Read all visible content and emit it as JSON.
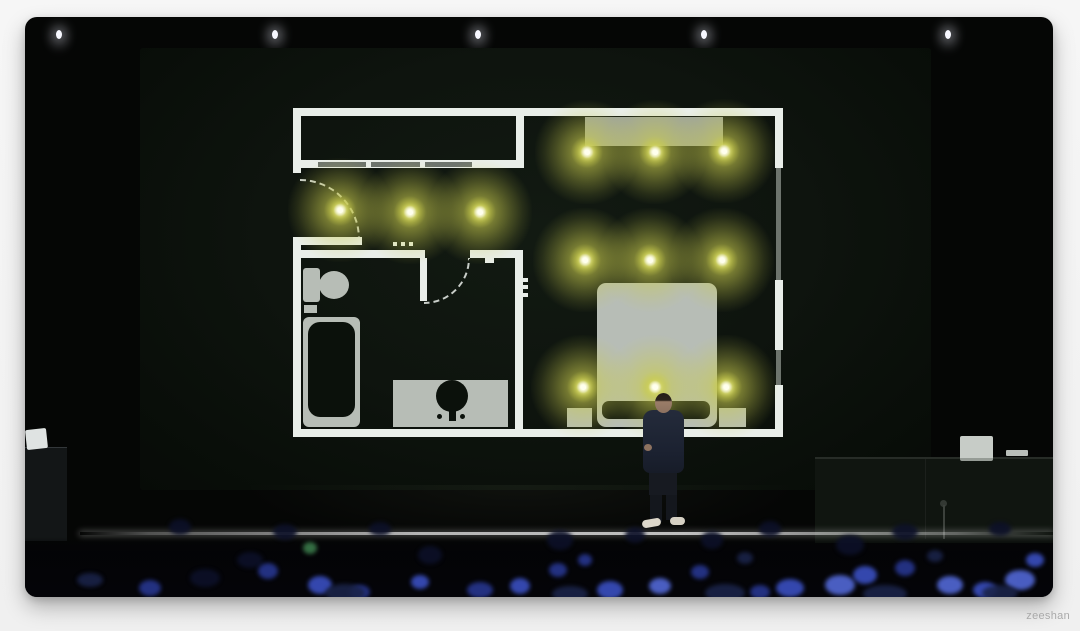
{
  "watermark": {
    "text": "zeeshan"
  },
  "scene": {
    "type": "keynote-stage-photo",
    "ceiling_lights": {
      "count": 5,
      "x_positions": [
        34,
        250,
        453,
        679,
        923
      ],
      "y": 13,
      "color": "#f7f8ff"
    }
  },
  "floor_plan": {
    "background": "#0b110b",
    "wall_color": "#e9eee9",
    "window_color": "#6d746d",
    "furniture_color": "#b7bdb6",
    "light_color": "#c9cc4e",
    "light_core_color": "#fffef2",
    "lights_on_count": 12,
    "rooms": [
      "closet",
      "hallway",
      "bathroom",
      "bedroom"
    ],
    "fixtures": [
      "closet-doors",
      "entry-door",
      "bathroom-door",
      "toilet",
      "bathtub",
      "vanity-sink",
      "console",
      "bed",
      "nightstand-left",
      "nightstand-right"
    ],
    "lights": [
      {
        "room": "hallway",
        "x": 47,
        "y": 102
      },
      {
        "room": "hallway",
        "x": 117,
        "y": 104
      },
      {
        "room": "hallway",
        "x": 187,
        "y": 104
      },
      {
        "room": "bedroom",
        "x": 294,
        "y": 44
      },
      {
        "room": "bedroom",
        "x": 362,
        "y": 44
      },
      {
        "room": "bedroom",
        "x": 431,
        "y": 43
      },
      {
        "room": "bedroom",
        "x": 292,
        "y": 152
      },
      {
        "room": "bedroom",
        "x": 357,
        "y": 152
      },
      {
        "room": "bedroom",
        "x": 429,
        "y": 152
      },
      {
        "room": "bedroom",
        "x": 290,
        "y": 279
      },
      {
        "room": "bedroom",
        "x": 362,
        "y": 279
      },
      {
        "room": "bedroom",
        "x": 433,
        "y": 279
      }
    ]
  },
  "presenter": {
    "shirt_color": "#1d2330",
    "pants_color": "#14171d",
    "shoe_color": "#ddd8cb",
    "skin_color": "#9a7d68"
  },
  "audience": {
    "palette": [
      "#14205c",
      "#27368f",
      "#3a4fc0",
      "#5268d6",
      "#1a2348",
      "#3a7a4a",
      "#0c1028"
    ],
    "blobs": [
      [
        65,
        563,
        26,
        14,
        4
      ],
      [
        125,
        571,
        22,
        16,
        1
      ],
      [
        180,
        561,
        30,
        18,
        6
      ],
      [
        225,
        543,
        26,
        16,
        6
      ],
      [
        243,
        554,
        20,
        16,
        1
      ],
      [
        285,
        531,
        14,
        12,
        5
      ],
      [
        295,
        568,
        24,
        18,
        2
      ],
      [
        335,
        575,
        20,
        14,
        1
      ],
      [
        395,
        565,
        18,
        14,
        2
      ],
      [
        405,
        538,
        24,
        18,
        6
      ],
      [
        455,
        573,
        26,
        16,
        1
      ],
      [
        495,
        569,
        20,
        16,
        2
      ],
      [
        533,
        553,
        18,
        14,
        1
      ],
      [
        535,
        523,
        26,
        20,
        6
      ],
      [
        560,
        543,
        14,
        12,
        1
      ],
      [
        585,
        573,
        26,
        18,
        2
      ],
      [
        635,
        569,
        22,
        16,
        3
      ],
      [
        675,
        555,
        18,
        14,
        1
      ],
      [
        687,
        523,
        22,
        18,
        6
      ],
      [
        720,
        541,
        16,
        12,
        4
      ],
      [
        735,
        575,
        20,
        14,
        1
      ],
      [
        765,
        571,
        28,
        18,
        2
      ],
      [
        815,
        568,
        30,
        20,
        3
      ],
      [
        825,
        528,
        28,
        20,
        6
      ],
      [
        840,
        558,
        24,
        18,
        2
      ],
      [
        880,
        551,
        20,
        16,
        1
      ],
      [
        910,
        539,
        16,
        12,
        4
      ],
      [
        925,
        568,
        26,
        18,
        3
      ],
      [
        960,
        573,
        24,
        16,
        2
      ],
      [
        995,
        563,
        30,
        20,
        3
      ],
      [
        1010,
        543,
        18,
        14,
        2
      ],
      [
        155,
        510,
        22,
        16,
        6
      ],
      [
        260,
        515,
        24,
        16,
        6
      ],
      [
        355,
        512,
        22,
        14,
        6
      ],
      [
        610,
        518,
        20,
        16,
        6
      ],
      [
        745,
        512,
        22,
        16,
        6
      ],
      [
        880,
        515,
        26,
        16,
        6
      ],
      [
        975,
        512,
        22,
        14,
        6
      ],
      [
        320,
        576,
        40,
        18,
        4
      ],
      [
        545,
        577,
        36,
        16,
        4
      ],
      [
        700,
        576,
        40,
        18,
        4
      ],
      [
        860,
        577,
        44,
        18,
        4
      ],
      [
        975,
        576,
        36,
        16,
        4
      ]
    ]
  }
}
